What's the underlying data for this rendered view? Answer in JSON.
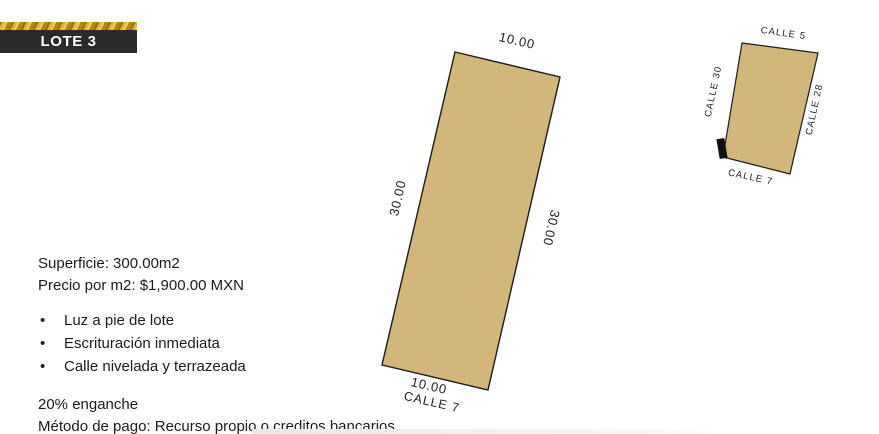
{
  "badge": {
    "label": "LOTE 3"
  },
  "details": {
    "superficie": "Superficie: 300.00m2",
    "precio": "Precio por m2: $1,900.00 MXN",
    "bullets": [
      "Luz a pie de lote",
      "Escrituración inmediata",
      "Calle nivelada y terrazeada"
    ],
    "enganche": "20% enganche",
    "metodo_pago": "Método de pago: Recurso propio o creditos bancarios"
  },
  "lot_diagram": {
    "top_dim": "10.00",
    "left_dim": "30.00",
    "right_dim": "30.00",
    "bottom_dim": "10.00",
    "bottom_street": "CALLE 7",
    "width_m": 10.0,
    "depth_m": 30.0,
    "fill_color": "#d3b67c",
    "outline_color": "#1c1c1c"
  },
  "mini_map": {
    "street_top": "CALLE 5",
    "street_left": "CALLE 30",
    "street_right": "CALLE 28",
    "street_bottom": "CALLE 7",
    "block_fill": "#d3b67c",
    "marker_color": "#111111"
  },
  "colors": {
    "badge_bg": "#2b2b2b",
    "badge_text": "#ffffff",
    "gold_accent": "#d4a12c"
  }
}
